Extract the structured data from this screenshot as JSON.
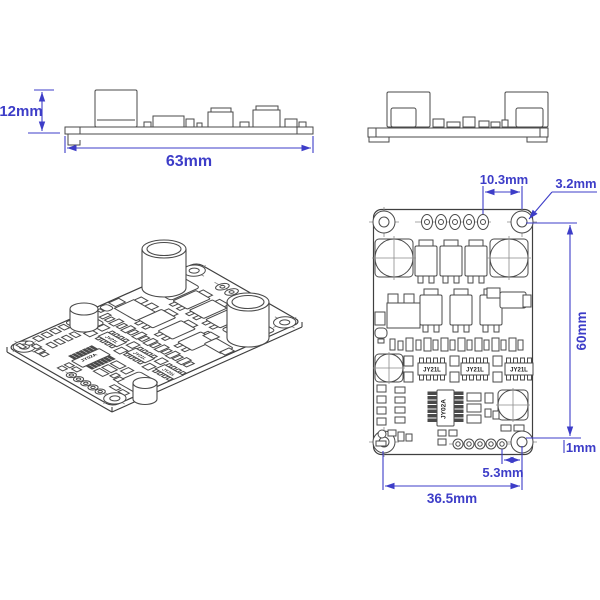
{
  "drawing": {
    "type": "mechanical-dimension-drawing",
    "subject": "PCB motor driver board",
    "colors": {
      "dimension": "#3d3dc8",
      "line": "#4a4a4a"
    },
    "side_view": {
      "dim_height": "12mm",
      "dim_length": "63mm"
    },
    "top_view": {
      "dim_pad_to_hole": "10.3mm",
      "dim_hole_diameter": "3.2mm",
      "dim_board_height": "60mm",
      "dim_edge_offset": "1mm",
      "dim_pad_offset": "5.3mm",
      "dim_hole_span": "36.5mm"
    },
    "ic_labels": {
      "driver": "JY21L",
      "mcu": "JY02A"
    }
  }
}
